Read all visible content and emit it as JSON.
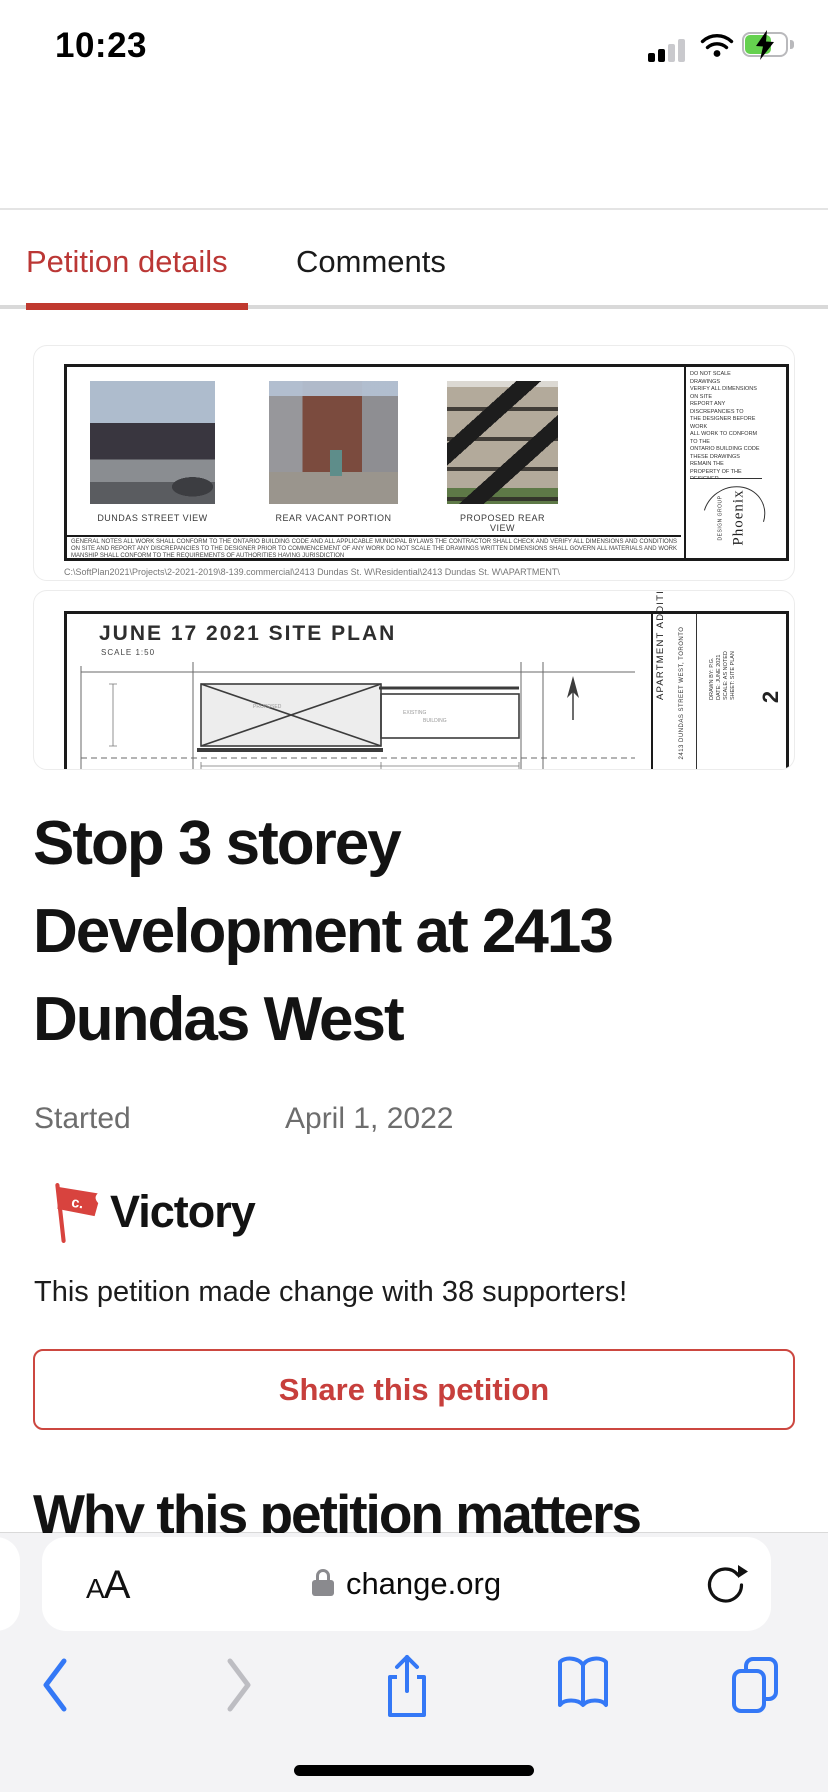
{
  "status_bar": {
    "time": "10:23"
  },
  "header": {
    "logo": "change.org"
  },
  "tabs": {
    "petition_details": "Petition details",
    "comments": "Comments"
  },
  "petition_image": {
    "photo_captions": [
      "DUNDAS STREET VIEW",
      "REAR VACANT PORTION",
      "PROPOSED REAR VIEW"
    ],
    "firm_name": "Phoenix",
    "firm_sub": "DESIGN GROUP",
    "illegible_notes": "DO NOT SCALE DRAWINGS\nVERIFY ALL DIMENSIONS ON SITE\nREPORT ANY DISCREPANCIES TO\nTHE DESIGNER BEFORE WORK\nALL WORK TO CONFORM TO THE\nONTARIO BUILDING CODE\nTHESE DRAWINGS REMAIN THE\nPROPERTY OF THE DESIGNER\nWRITTEN DIMENSIONS GOVERN\nOVER SCALED DIMENSIONS\nCONTRACTOR RESPONSIBLE FOR\nALL SITE SAFETY MEASURES\nDRAWINGS NOT TO BE USED FOR\nCONSTRUCTION UNLESS SIGNED",
    "illegible_fine_print": "GENERAL NOTES ALL WORK SHALL CONFORM TO THE ONTARIO BUILDING CODE AND ALL APPLICABLE MUNICIPAL BYLAWS THE CONTRACTOR SHALL CHECK AND VERIFY ALL DIMENSIONS AND CONDITIONS ON SITE AND REPORT ANY DISCREPANCIES TO THE DESIGNER PRIOR TO COMMENCEMENT OF ANY WORK DO NOT SCALE THE DRAWINGS WRITTEN DIMENSIONS SHALL GOVERN ALL MATERIALS AND WORKMANSHIP SHALL CONFORM TO THE REQUIREMENTS OF AUTHORITIES HAVING JURISDICTION",
    "file_path": "C:\\SoftPlan2021\\Projects\\2-2021-2019\\8-139.commercial\\2413 Dundas St. W\\Residential\\2413 Dundas St. W\\APARTMENT\\",
    "site_plan_title": "JUNE 17 2021 SITE PLAN",
    "site_plan_scale": "SCALE 1:50",
    "title_block_project": "APARTMENT ADDITION",
    "title_block_address": "2413 DUNDAS STREET WEST, TORONTO",
    "title_block_micro": "DRAWN BY: P.G.\nDATE: JUNE 2021\nSCALE: AS NOTED\nSHEET: SITE PLAN",
    "sheet_number": "2",
    "bottom_partial_label": "JUNE 17 2021 SITE PLAN 2"
  },
  "petition": {
    "title": "Stop 3 storey Development at 2413 Dundas West",
    "title_lines": [
      "Stop 3 storey",
      "Development at 2413",
      "Dundas West"
    ],
    "started_label": "Started",
    "started_date": "April 1, 2022",
    "victory_label": "Victory",
    "victory_flag_letter": "c.",
    "supporters_text": "This petition made change with 38 supporters!",
    "share_button": "Share this petition",
    "section_heading": "Why this petition matters"
  },
  "safari": {
    "reader_button": "AA",
    "url": "change.org"
  },
  "colors": {
    "brand_red": "#cd3a33",
    "accent_red": "#c0392f",
    "safari_blue": "#3478f6",
    "battery_green": "#65d14f"
  }
}
